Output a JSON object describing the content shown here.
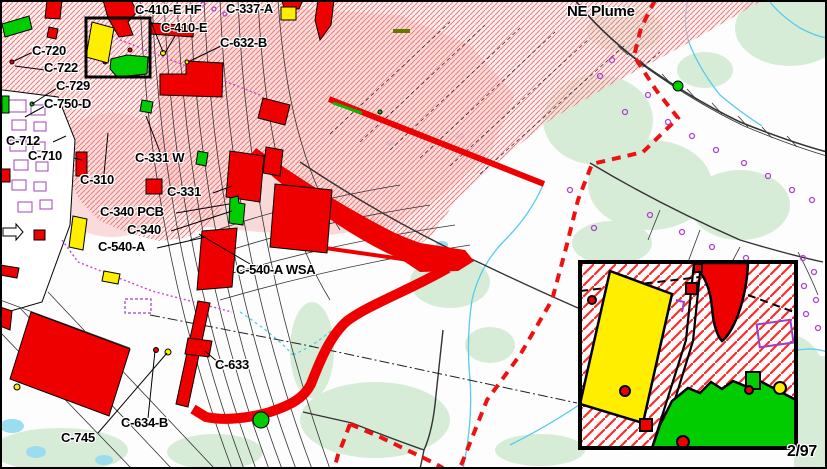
{
  "map": {
    "type": "site-plume-map",
    "date_stamp": "2/97"
  },
  "labels": {
    "c410ehf": "C-410-E HF",
    "c337a": "C-337-A",
    "c410e": "C-410-E",
    "c632b": "C-632-B",
    "ne_plume": "NE Plume",
    "c720": "C-720",
    "c722": "C-722",
    "c729": "C-729",
    "c750d": "C-750-D",
    "c712": "C-712",
    "c710": "C-710",
    "c331w": "C-331 W",
    "c310": "C-310",
    "c331": "C-331",
    "c340pcb": "C-340 PCB",
    "c340": "C-340",
    "c540a": "C-540-A",
    "c540awsa": "C-540-A WSA",
    "c633": "C-633",
    "c634b": "C-634-B",
    "c745": "C-745",
    "date": "2/97"
  },
  "colors": {
    "building_red": "#ee0000",
    "building_yellow": "#ffee00",
    "building_green": "#00cc00",
    "plume_hatch": "#ee7d7d",
    "plume_core": "#f6baba",
    "boundary_dashed_red": "#ee1111",
    "stream_cyan": "#55ccee",
    "vegetation": "#d7ecd7",
    "symbol_purple": "#aa44cc",
    "label_text": "#000000"
  }
}
